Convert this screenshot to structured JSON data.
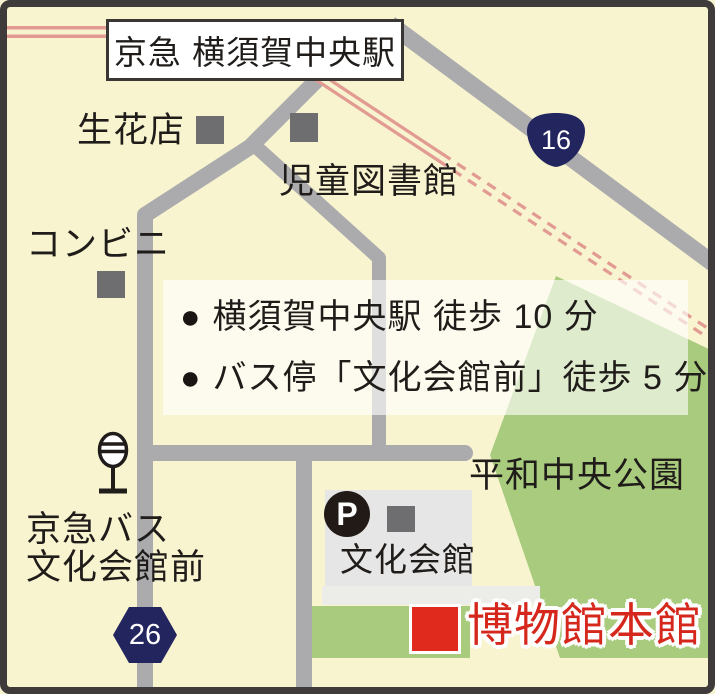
{
  "map": {
    "station_box": {
      "label": "京急 横須賀中央駅"
    },
    "poi": {
      "flower_shop": "生花店",
      "children_library": "児童図書館",
      "convenience_store": "コンビニ",
      "peace_park": "平和中央公園",
      "bus_stop_line1": "京急バス",
      "bus_stop_line2": "文化会館前",
      "culture_hall": "文化会館",
      "museum_main": "博物館本館"
    },
    "route_badges": {
      "route16": "16",
      "route26": "26"
    },
    "parking_badge": "P",
    "directions": [
      {
        "bullet": "●",
        "text": "横須賀中央駅 徒歩 10 分"
      },
      {
        "bullet": "●",
        "text": "バス停「文化会館前」徒歩 5 分"
      }
    ],
    "colors": {
      "background": "#F8F4D0",
      "road": "#ABABAD",
      "railway": "#E29B93",
      "park_green": "#A8CB7D",
      "route_badge_navy": "#23265E",
      "museum_red": "#DC2B20",
      "building_gray": "#6E6E70",
      "hall_block_gray": "#E6E6E6",
      "border_dark": "#3F3B3B"
    }
  }
}
